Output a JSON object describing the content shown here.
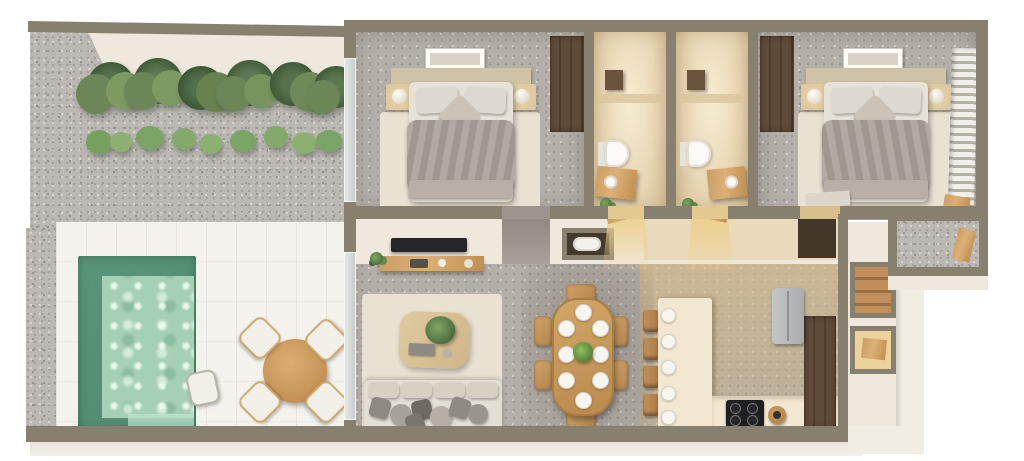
{
  "scene": {
    "kind": "3d-floor-plan-render",
    "view": "top-down axonometric",
    "title": "Apartment floor plan with pool terrace",
    "visible_text": "none"
  },
  "palette": {
    "background": "#ffffff",
    "wall": "#87806f",
    "wall_face": "#efe9dd",
    "gravel": "#bcb9b4",
    "pool_deck": "#f4f2ed",
    "pool_deep_water": "#579478",
    "pool_shallow_water": "#a6d0b5",
    "terrazzo_floor": "#b4afa9",
    "bathroom_floor": "#ead9b8",
    "rug": "#e9e2d3",
    "wood": "#c89c62",
    "dark_wood": "#5a4836",
    "duvet": "#a8a097",
    "sofa": "#e2ddd3",
    "tv": "#26262a",
    "cooktop": "#1f1f22",
    "fridge": "#b9bcbc",
    "plant_green": "#5c7a4c",
    "warm_light": "#eccc86"
  },
  "outdoor": {
    "name": "Pool terrace",
    "planting_bed_clusters": 6,
    "pool": {
      "shape": "rectangular",
      "has_steps": true
    },
    "outdoor_dining": {
      "table": "round wood table",
      "chairs": 4
    },
    "pool_stool_count": 1
  },
  "rooms": [
    {
      "name": "Bedroom 1",
      "furniture": [
        "double bed",
        "2 pillows",
        "accent pillow",
        "2 nightstands",
        "2 lamps",
        "wall art",
        "wardrobe",
        "rug",
        "window"
      ]
    },
    {
      "name": "Bathroom 1",
      "furniture": [
        "walk-in shower",
        "shower fixture",
        "toilet",
        "wood vanity with sink",
        "plant",
        "door"
      ]
    },
    {
      "name": "Bathroom 2",
      "furniture": [
        "walk-in shower",
        "shower fixture",
        "toilet",
        "wood vanity with sink",
        "plant",
        "door"
      ]
    },
    {
      "name": "Bedroom 2",
      "furniture": [
        "double bed",
        "2 pillows",
        "accent pillow",
        "2 nightstands",
        "2 lamps",
        "wall art",
        "wardrobe",
        "rug",
        "window with blinds",
        "bench"
      ]
    },
    {
      "name": "Living room",
      "furniture": [
        "wall TV",
        "media console with decor",
        "sofa",
        "7 scatter cushions",
        "coffee table with plant",
        "rug",
        "glass slider to terrace"
      ]
    },
    {
      "name": "Dining area",
      "furniture": [
        "oval wood table",
        "6 chairs",
        "8 place settings",
        "plant centerpiece"
      ]
    },
    {
      "name": "Kitchen",
      "furniture": [
        "island with 5 place settings",
        "4 bar stools",
        "cooktop with 4 burners",
        "refrigerator",
        "tall cabinets",
        "side stool"
      ]
    },
    {
      "name": "Hallway",
      "furniture": [
        "laundry niche with washer bundle"
      ]
    },
    {
      "name": "Entry",
      "furniture": [
        "wood staircase",
        "lit storage nook"
      ]
    },
    {
      "name": "Rear lightwell",
      "furniture": [
        "gravel floor",
        "wood plank"
      ]
    }
  ],
  "counts": {
    "dining_plates": 8,
    "island_plates": 5,
    "bar_stools": 4,
    "dining_chairs": 6,
    "outdoor_chairs": 4,
    "sofa_cushions": 7,
    "cooktop_burners": 4,
    "plant_clusters": 6
  }
}
